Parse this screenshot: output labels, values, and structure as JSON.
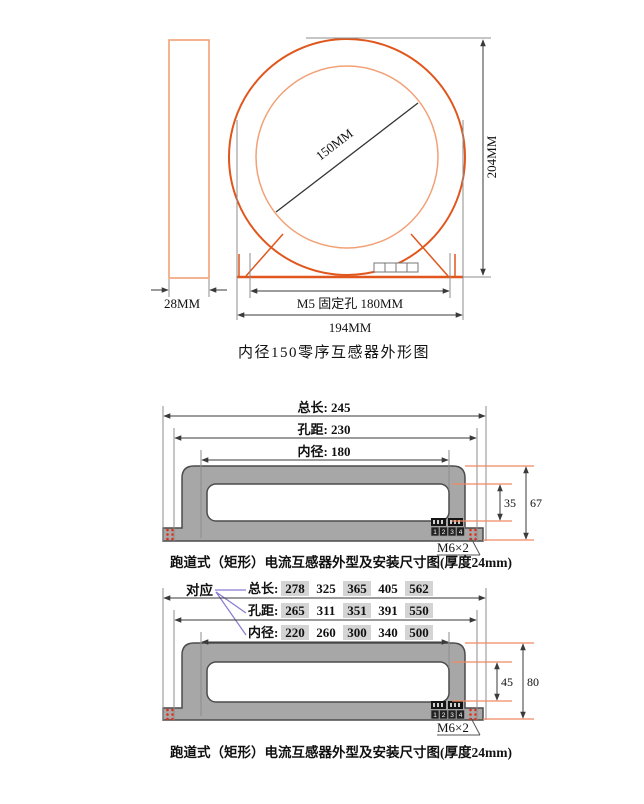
{
  "colors": {
    "outline_orange": "#e0561c",
    "outline_salmon": "#f2a176",
    "dim_gray": "#8d8d8d",
    "dim_dark": "#3a3a3a",
    "body_gray": "#a7a7a7",
    "body_border": "#4c4c4c",
    "hole_red": "#e03018",
    "link_purple": "#8a7ad0",
    "accent_blue": "#39399b",
    "cell_gray": "#d4d4d4"
  },
  "figure1": {
    "caption": "内径150零序互感器外形图",
    "side_width": "28MM",
    "inner_diameter": "150MM",
    "height": "204MM",
    "mount_holes": "M5 固定孔 180MM",
    "total_width": "194MM"
  },
  "figure2": {
    "caption": "跑道式（矩形）电流互感器外型及安装尺寸图(厚度24mm)",
    "total_length": "总长: 245",
    "hole_distance": "孔距: 230",
    "inner_diameter": "内径: 180",
    "window_height": "35",
    "body_height": "67",
    "mount_spec": "M6×2",
    "terminals": [
      "1",
      "2",
      "3",
      "4"
    ]
  },
  "figure3": {
    "caption": "跑道式（矩形）电流互感器外型及安装尺寸图(厚度24mm)",
    "correspondence": "对应",
    "rows": [
      {
        "label": "总长:",
        "values": [
          "278",
          "325",
          "365",
          "405",
          "562"
        ]
      },
      {
        "label": "孔距:",
        "values": [
          "265",
          "311",
          "351",
          "391",
          "550"
        ]
      },
      {
        "label": "内径:",
        "values": [
          "220",
          "260",
          "300",
          "340",
          "500"
        ]
      }
    ],
    "window_height": "45",
    "body_height": "80",
    "mount_spec": "M6×2",
    "terminals": [
      "1",
      "2",
      "3",
      "4"
    ]
  }
}
